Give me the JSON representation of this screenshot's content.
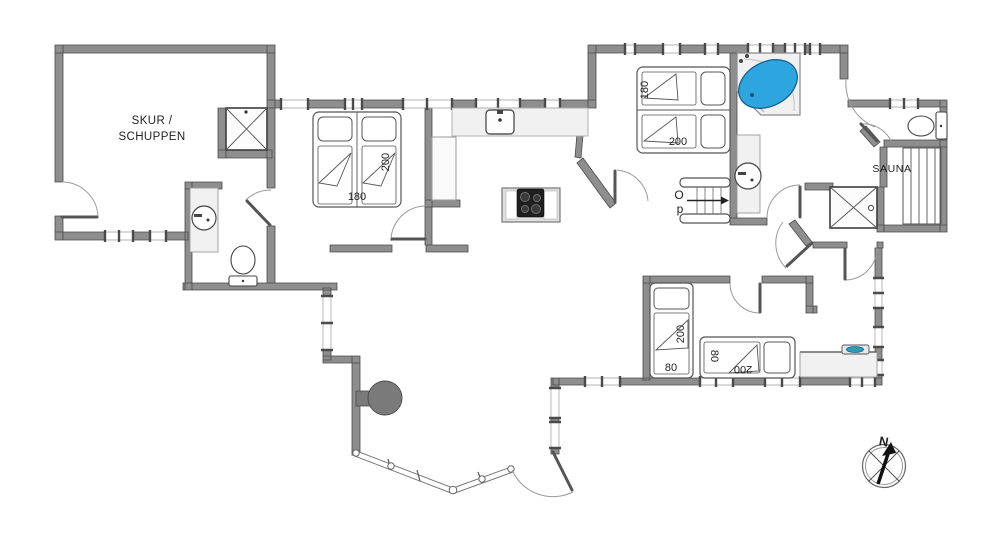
{
  "floorplan": {
    "rooms": {
      "skur": {
        "label_line1": "SKUR /",
        "label_line2": "SCHUPPEN"
      },
      "sauna": {
        "label": "SAUNA"
      }
    },
    "stairs": {
      "label_letter1": "O",
      "label_letter2": "p"
    },
    "compass": {
      "north_label": "N"
    },
    "beds": {
      "double_bed_west": {
        "width_cm": "180",
        "length_cm": "200"
      },
      "double_bed_middle": {
        "width_cm": "180",
        "length_cm": "200"
      },
      "single_bed_vertical": {
        "width_cm": "80",
        "length_cm": "200"
      },
      "single_bed_horizontal": {
        "width_cm": "80",
        "length_cm": "200"
      }
    },
    "colors": {
      "wall_fill": "#8e8e8e",
      "wall_stroke": "#4a4a4a",
      "fixture_fill": "#f1f1f1",
      "whirlpool_blue": "#2da6e0",
      "sink_teal": "#2d9db3",
      "cooktop_black": "#1f1f1f",
      "fireplace_gray": "#7a7a7a"
    }
  }
}
